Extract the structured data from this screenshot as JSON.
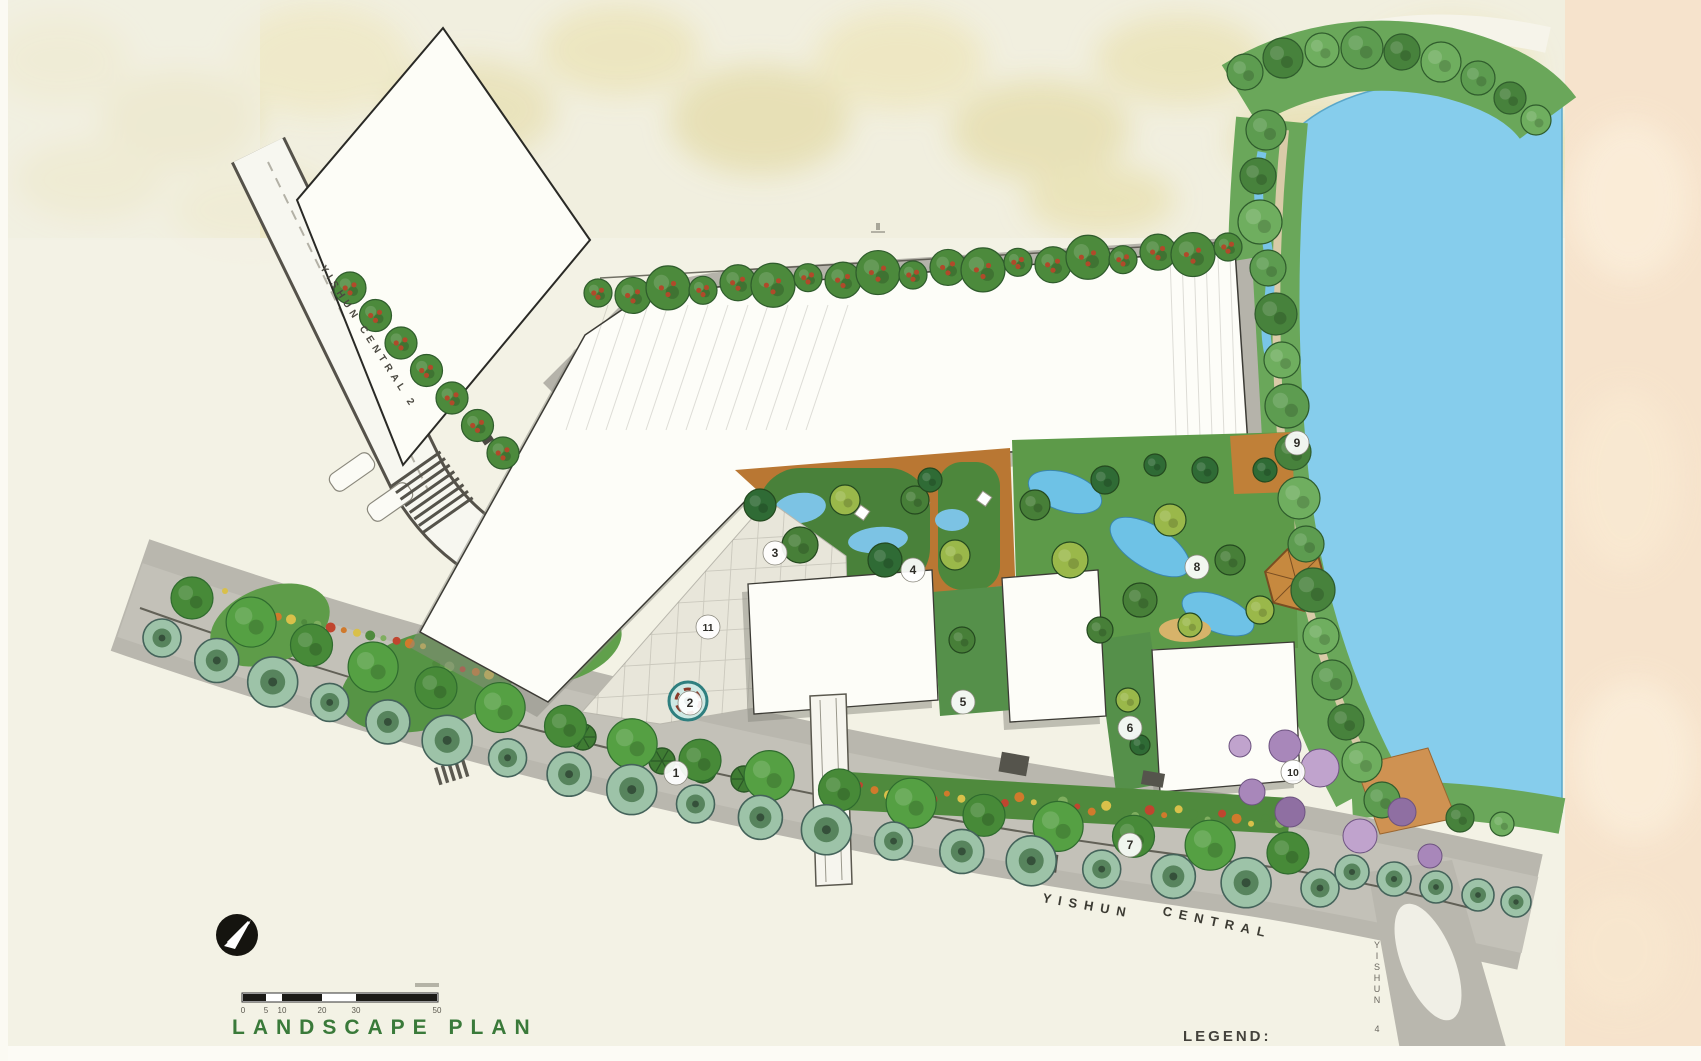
{
  "title": "LANDSCAPE PLAN",
  "legend_label": "LEGEND:",
  "roads": {
    "bottom_word1": "YISHUN",
    "bottom_word2": "CENTRAL",
    "left": "YISHUN CENTRAL 2",
    "right_vertical": "YISHUN 4"
  },
  "scale_bar": {
    "ticks": [
      "0",
      "5",
      "10",
      "20",
      "30",
      "50"
    ]
  },
  "markers": [
    "1",
    "2",
    "3",
    "4",
    "5",
    "6",
    "7",
    "8",
    "9",
    "10",
    "11"
  ],
  "palette": {
    "title_green": "#3a7a3a",
    "pond_blue": "#86cdec",
    "road_gray": "#b9b7ae",
    "canopy_green": "#4f8a3d",
    "terrace_orange": "#b97733",
    "backdrop_cream": "#f1efdf",
    "backdrop_peach": "#f6e3cc"
  }
}
